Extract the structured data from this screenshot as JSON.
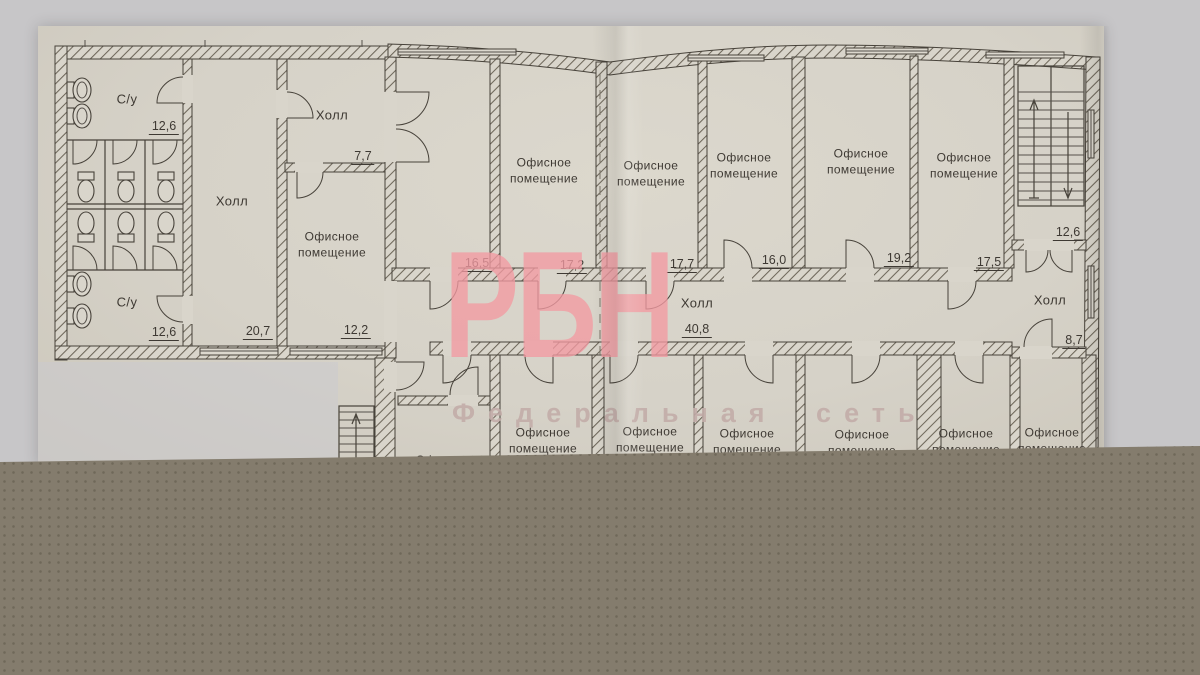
{
  "watermark": {
    "logo": "РБН",
    "tagline": "Федеральная сеть",
    "pink": "#f29aa2"
  },
  "colors": {
    "paper": "#d6d2c8",
    "background": "#c7c6c8",
    "desk_band": "#847c6d",
    "ink": "#3e3933"
  },
  "left_block": {
    "su_top": {
      "label": "С/у",
      "area": "12,6"
    },
    "su_bottom": {
      "label": "С/у",
      "area": "12,6"
    },
    "hall": {
      "label": "Холл",
      "area": "20,7"
    },
    "hall_small": {
      "label": "Холл",
      "area": "7,7"
    },
    "office": {
      "label": "Офисное\nпомещение",
      "area": "12,2"
    }
  },
  "top_row": [
    {
      "label": "",
      "area": "16,5"
    },
    {
      "label": "Офисное\nпомещение",
      "area": "17,2"
    },
    {
      "label": "Офисное\nпомещение",
      "area": "17,7"
    },
    {
      "label": "Офисное\nпомещение",
      "area": "16,0"
    },
    {
      "label": "Офисное\nпомещение",
      "area": "19,2"
    },
    {
      "label": "Офисное\nпомещение",
      "area": "17,5"
    }
  ],
  "corridor": {
    "label": "Холл",
    "area": "40,8"
  },
  "right_wing": {
    "stairs_area": "12,6",
    "hall": {
      "label": "Холл",
      "area": "8,7"
    }
  },
  "bottom_row": [
    {
      "label": "Офисное\nпомещение"
    },
    {
      "label": "Офисное\nпомещение"
    },
    {
      "label": "Офисное\nпомещение"
    },
    {
      "label": "Офисное\nпомещение"
    },
    {
      "label": "Офисное\nпомещение"
    },
    {
      "label": "Офисное\nпомещение"
    }
  ],
  "bottom_partial": {
    "label": "Офисное"
  }
}
